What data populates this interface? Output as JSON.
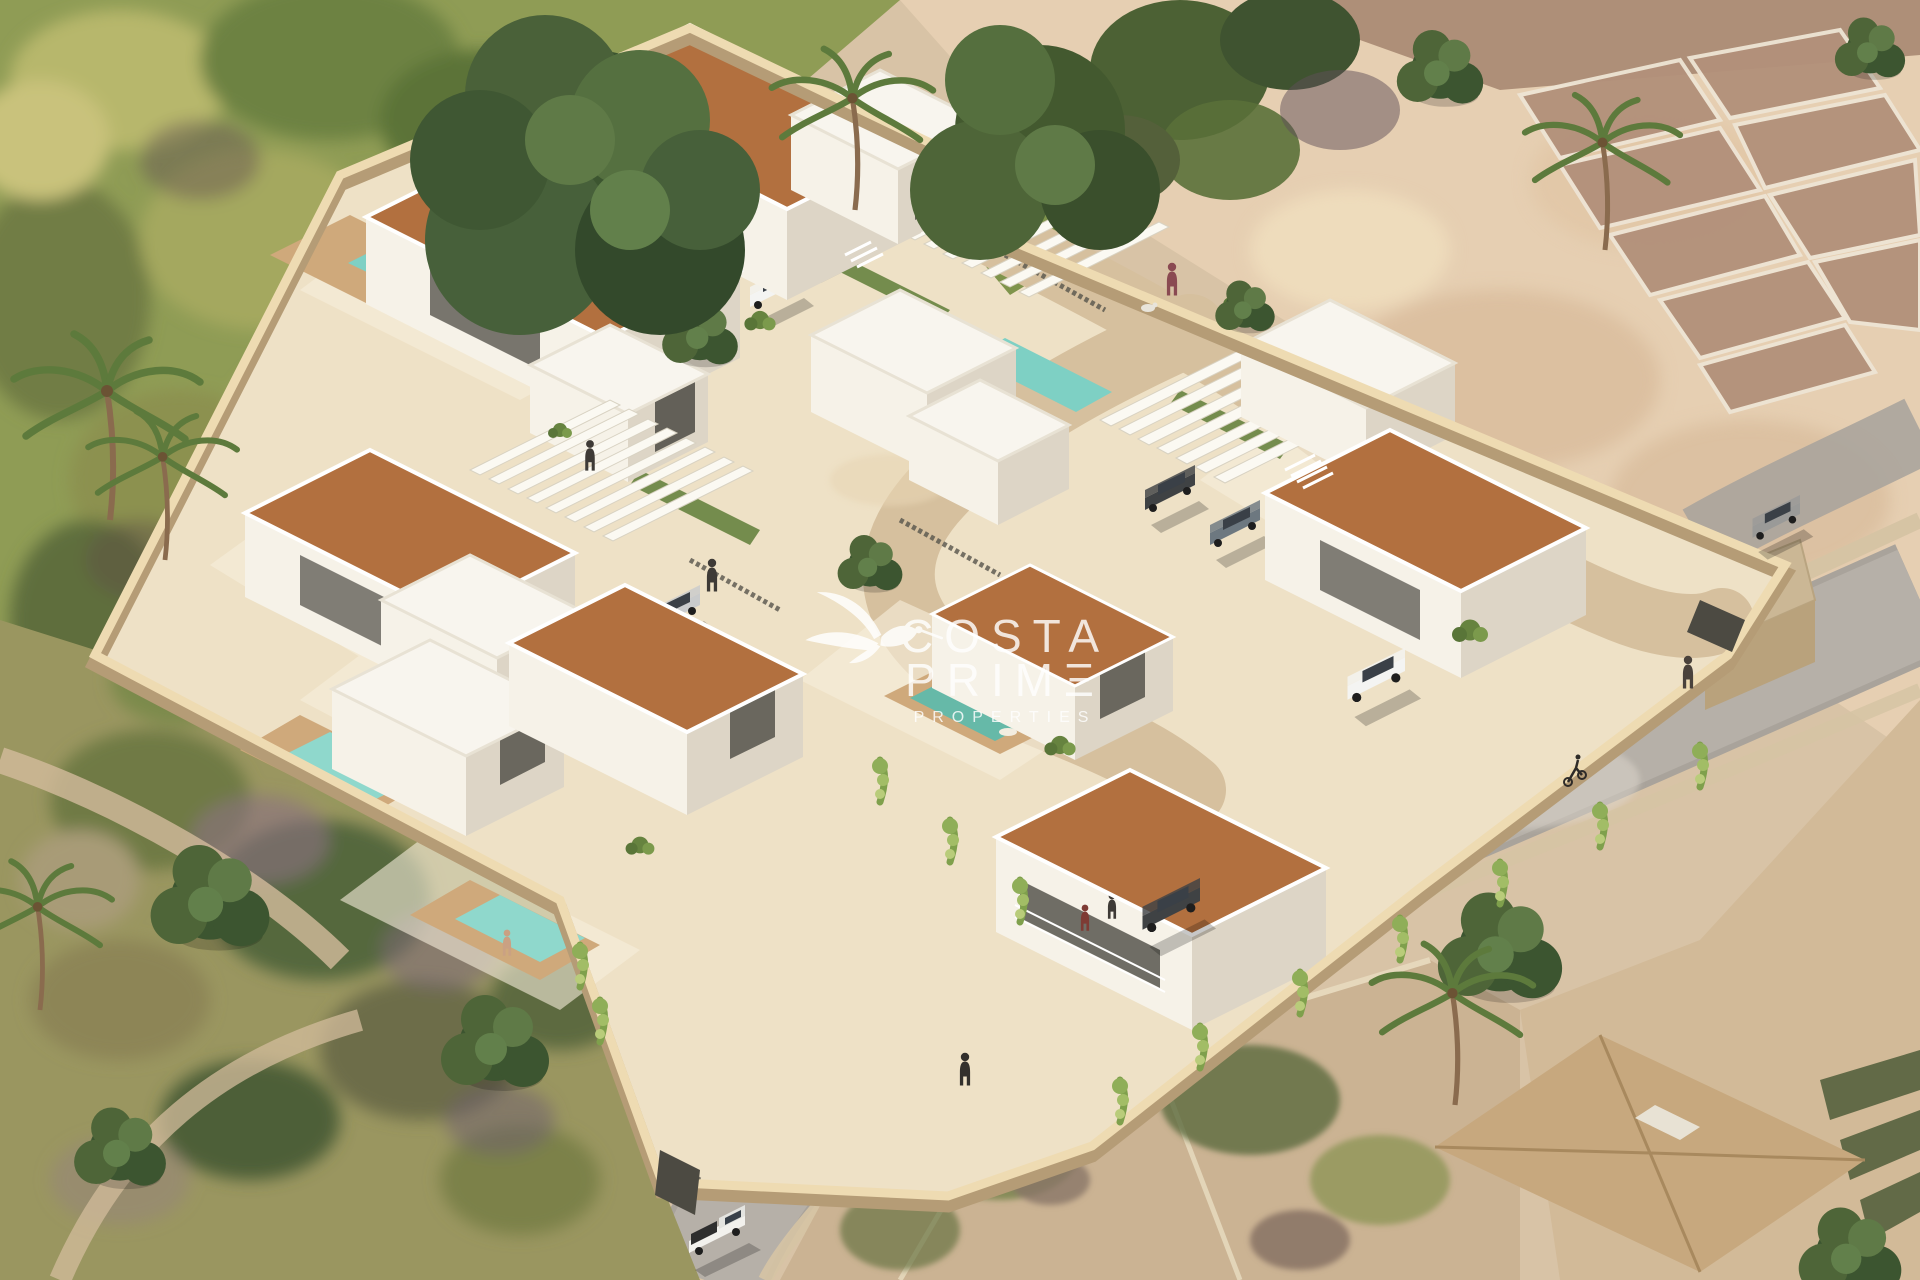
{
  "watermark": {
    "brand_line1": "COSTA",
    "brand_line2": "PRIMΞ",
    "brand_line3": "PROPERTIES",
    "logo_icon": "hummingbird-logo-icon",
    "color": "#ffffff"
  },
  "scene": {
    "type": "3d-aerial-render",
    "description": "Aerial isometric 3D render of a gated residential development of white modern villas with terracotta roofs, private pools, white pergola carports and a curving internal road, surrounded by green woodland, sandy fields with old stone ruins, scrubland plots and perimeter streets with cars, a cyclist and pedestrians."
  },
  "objects": {
    "villas": 10,
    "pools": 5,
    "pergola_carports": 3,
    "cars": 8,
    "people": 8
  },
  "palette": {
    "sand": "#d8c3a6",
    "sandLight": "#e6cfb2",
    "greenField": "#8f9c55",
    "scrub": "#9a9660",
    "street": "#b6b0a8",
    "ground": "#eee1c6",
    "roadIn": "#d6c09e",
    "roof": "#b2703f",
    "white": "#f6f2e8",
    "whiteShade": "#ddd5c6",
    "flatRoof": "#f8f5ee",
    "pool": "#7ed0c4",
    "poolGreen": "#66b9a8",
    "deck": "#cfa97b",
    "vine": "#8fae58",
    "hedge": "#66833f",
    "treeDark": "#3c5530",
    "treeMid": "#4e6538",
    "wallTop": "#eedbb2",
    "wallShade": "#b59c76",
    "gate": "#4c4a42",
    "win": "#4e4b44",
    "stone": "#d6c4a4",
    "rubble": "#b2907a",
    "ruinEdge": "#eee4d4",
    "neighborRoof": "#c7a87e",
    "carWhite": "#f4f4f2",
    "carSilver": "#c9cbcc",
    "carDark": "#3f4244",
    "carRed": "#7e3b34",
    "watermark": "#ffffff"
  }
}
